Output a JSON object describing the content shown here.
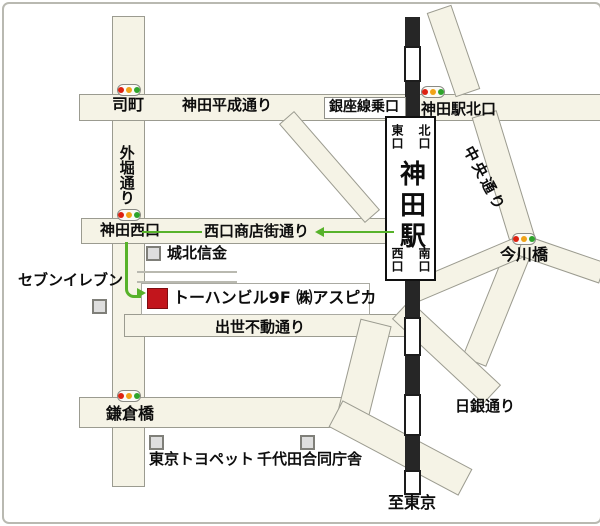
{
  "colors": {
    "road_fill": "#f5f3e6",
    "road_border": "#9b9b90",
    "rail_black": "#262626",
    "route_green": "#57b22a",
    "destination_red": "#c2151c",
    "building_gray": "#dedede",
    "signal_red": "#dd2211",
    "signal_amber": "#f0a318",
    "signal_green": "#2fa42b"
  },
  "station": {
    "name": "神田駅",
    "exit_top_left": "東口",
    "exit_top_right": "北口",
    "exit_bottom_left": "西口",
    "exit_bottom_right": "南口"
  },
  "labels": {
    "tsukasamachi": "司町",
    "heisei_dori": "神田平成通り",
    "sotobori_dori": "外堀通り",
    "ginza_line_entrance": "銀座線乗口",
    "kanda_sta_north": "神田駅北口",
    "chuo_dori": "中央通り",
    "imagawabashi": "今川橋",
    "kanda_nishiguchi": "神田西口",
    "nishiguchi_shotengai_dori": "西口商店街通り",
    "johoku_shinkin": "城北信金",
    "seven_eleven": "セブンイレブン",
    "destination": "トーハンビル9F ㈱アスピカ",
    "shusse_fudo_dori": "出世不動通り",
    "nichigin_dori": "日銀通り",
    "kamakurabashi": "鎌倉橋",
    "tokyo_toyopet": "東京トヨペット",
    "chiyoda_godochosha": "千代田合同庁舎",
    "to_tokyo": "至東京"
  }
}
